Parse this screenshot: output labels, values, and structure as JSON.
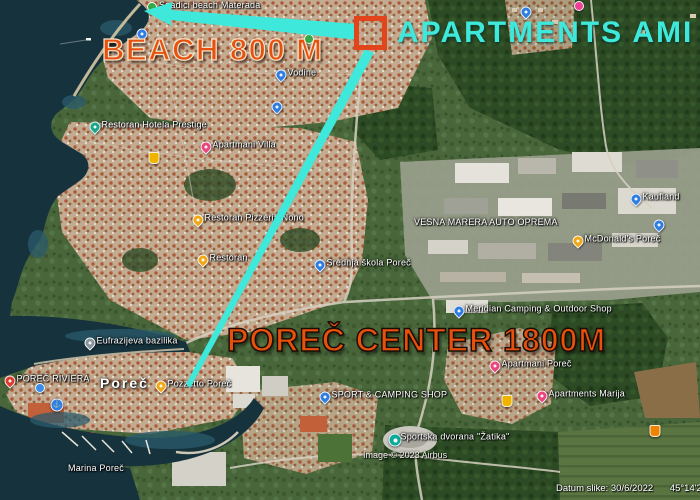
{
  "annotations": {
    "beach_label": "BEACH 800 M",
    "apartments_label": "APARTMENTS AMI",
    "center_label": "POREČ CENTER 1800M"
  },
  "town_label": "Poreč",
  "attribution": {
    "image_credit": "Image © 2023 Airbus",
    "date": "Datum slike: 30/6/2022",
    "coordinates": "45°14'23.52\""
  },
  "colors": {
    "annotation_orange": "#e8500d",
    "annotation_cyan": "#3ee8da",
    "box_orange": "#e2441c"
  },
  "markers": [
    {
      "name": "materada-beach-marker",
      "type": "dot-green",
      "icon": "green-dot-icon",
      "x": 152,
      "y": 7,
      "label": "Spadici beach Materada"
    },
    {
      "name": "hotel-prestige-restaurant-marker",
      "type": "pin-teal",
      "icon": "restaurant-pin-icon",
      "x": 95,
      "y": 127,
      "label": "Restoran Hotela Prestige"
    },
    {
      "name": "poi-marker-1",
      "type": "pin-blue",
      "icon": "place-pin-icon",
      "x": 142,
      "y": 34
    },
    {
      "name": "villa-apartments-marker",
      "type": "pin-pink",
      "icon": "lodging-pin-icon",
      "x": 206,
      "y": 147,
      "label": "Apartmani Villa"
    },
    {
      "name": "vodine-marker",
      "type": "pin-blue",
      "icon": "place-pin-icon",
      "x": 281,
      "y": 75,
      "label": "Vodine"
    },
    {
      "name": "poi-marker-2",
      "type": "pin-blue",
      "icon": "place-pin-icon",
      "x": 277,
      "y": 107
    },
    {
      "name": "pizzeria-nono-marker",
      "type": "pin-yellow",
      "icon": "restaurant-pin-icon",
      "x": 198,
      "y": 220,
      "label": "Restoran Pizzeria Nono"
    },
    {
      "name": "restaurant-marker",
      "type": "pin-yellow",
      "icon": "restaurant-pin-icon",
      "x": 203,
      "y": 260,
      "label": "Restoran"
    },
    {
      "name": "school-marker",
      "type": "pin-blue",
      "icon": "school-pin-icon",
      "x": 320,
      "y": 265,
      "label": "Srednja škola Poreč"
    },
    {
      "name": "kaufland-marker",
      "type": "pin-blue",
      "icon": "store-pin-icon",
      "x": 636,
      "y": 199,
      "label": "Kaufland"
    },
    {
      "name": "poi-marker-3",
      "type": "pin-blue",
      "icon": "place-pin-icon",
      "x": 659,
      "y": 225
    },
    {
      "name": "mcdonalds-marker",
      "type": "pin-yellow",
      "icon": "restaurant-pin-icon",
      "x": 578,
      "y": 241,
      "label": "McDonald's Poreč"
    },
    {
      "name": "auto-oprema-label",
      "type": "label-only",
      "x": 414,
      "y": 217,
      "label": "VESNA MARERA AUTO OPREMA"
    },
    {
      "name": "meridian-camping-marker",
      "type": "pin-blue",
      "icon": "store-pin-icon",
      "x": 459,
      "y": 311,
      "label": "Meridian Camping & Outdoor Shop"
    },
    {
      "name": "apartments-marker-1",
      "type": "pin-pink",
      "icon": "lodging-pin-icon",
      "x": 495,
      "y": 366,
      "label": "Apartmani Poreč"
    },
    {
      "name": "apartments-marija-marker",
      "type": "pin-pink",
      "icon": "lodging-pin-icon",
      "x": 542,
      "y": 396,
      "label": "Apartments Marija"
    },
    {
      "name": "poi-shield-marker-1",
      "type": "shield-yellow",
      "icon": "shield-icon",
      "x": 507,
      "y": 401
    },
    {
      "name": "poi-shield-marker-2",
      "type": "shield-orange",
      "icon": "shield-icon",
      "x": 655,
      "y": 431
    },
    {
      "name": "sport-camping-shop-marker",
      "type": "pin-blue",
      "icon": "store-pin-icon",
      "x": 325,
      "y": 397,
      "label": "SPORT & CAMPING SHOP"
    },
    {
      "name": "zatika-hall-marker",
      "type": "circle-teal",
      "icon": "sports-hall-icon",
      "x": 395,
      "y": 440,
      "label": "Sportska dvorana \"Žatika\""
    },
    {
      "name": "basilica-marker",
      "type": "pin-gray",
      "icon": "landmark-pin-icon",
      "x": 90,
      "y": 343,
      "label": "Eufrazijeva bazilika"
    },
    {
      "name": "porec-riviera-marker",
      "type": "pin-red",
      "icon": "place-pin-icon",
      "x": 10,
      "y": 381,
      "label": "POREČ RIVIERA"
    },
    {
      "name": "poi-dot-marker-1",
      "type": "dot-blue",
      "icon": "blue-dot-icon",
      "x": 40,
      "y": 388
    },
    {
      "name": "marina-anchor-marker",
      "type": "anchor",
      "icon": "anchor-icon",
      "x": 57,
      "y": 405,
      "glyph": "⚓"
    },
    {
      "name": "pozzetto-marker",
      "type": "pin-yellow",
      "icon": "restaurant-pin-icon",
      "x": 161,
      "y": 386,
      "label": "Pozzetto Poreč"
    },
    {
      "name": "poi-dot-marker-2",
      "type": "dot-pink",
      "icon": "pink-dot-icon",
      "x": 579,
      "y": 6
    },
    {
      "name": "poi-marker-4",
      "type": "pin-blue",
      "icon": "place-pin-icon",
      "x": 526,
      "y": 12
    },
    {
      "name": "marina-porec-label",
      "type": "label-only",
      "x": 68,
      "y": 463,
      "label": "Marina Poreč"
    },
    {
      "name": "poi-dot-marker-3",
      "type": "dot-green",
      "icon": "green-dot-icon",
      "x": 309,
      "y": 39
    },
    {
      "name": "poi-shield-marker-3",
      "type": "shield-yellow",
      "icon": "shield-icon",
      "x": 154,
      "y": 158
    }
  ]
}
